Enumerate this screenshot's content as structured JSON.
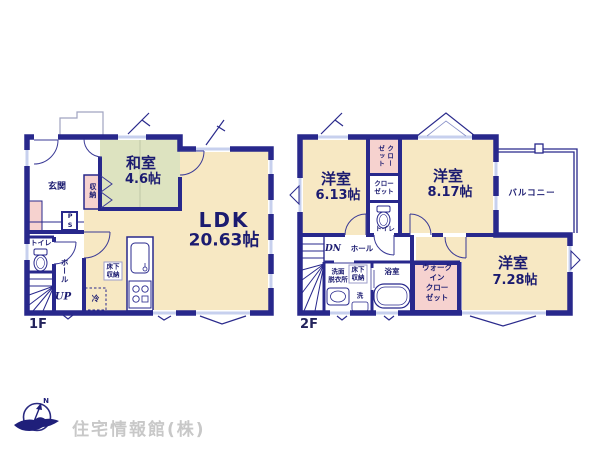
{
  "document": {
    "type": "floor-plan",
    "floors": [
      "1F",
      "2F"
    ]
  },
  "floor1": {
    "label": "1F",
    "washitsu_name": "和室",
    "washitsu_size": "4.6帖",
    "ldk_name": "LDK",
    "ldk_size": "20.63帖",
    "genkan": "玄関",
    "shunou": "収納",
    "ps": "PS",
    "toilet": "トイレ",
    "hall": "ホール",
    "up": "UP",
    "yukashita": "床下収納",
    "rei": "冷"
  },
  "floor2": {
    "label": "2F",
    "room1_name": "洋室",
    "room1_size": "6.13帖",
    "room2_name": "洋室",
    "room2_size": "8.17帖",
    "room3_name": "洋室",
    "room3_size": "7.28帖",
    "balcony": "バルコニー",
    "closet1_line1": "クロー",
    "closet1_line2": "ゼット",
    "closet2": "クローゼット",
    "toilet": "トイレ",
    "dn": "DN",
    "hall": "ホール",
    "senmen_line1": "洗面",
    "senmen_line2": "脱衣所",
    "yukashita": "床下収納",
    "washer": "洗",
    "bath": "浴室",
    "wic_line1": "ウォーク",
    "wic_line2": "イン",
    "wic_line3": "クロー",
    "wic_line4": "ゼット"
  },
  "logo": {
    "company": "住宅情報館(株)",
    "north": "N"
  },
  "colors": {
    "wall_navy": "#28288c",
    "floor_cream": "#f7e8c3",
    "tatami_green": "#dde3c0",
    "closet_pink": "#f6d2cf",
    "window_blue": "#c7d0ee",
    "label_navy": "#1b1b70",
    "logo_gray": "#c8c8c8"
  }
}
